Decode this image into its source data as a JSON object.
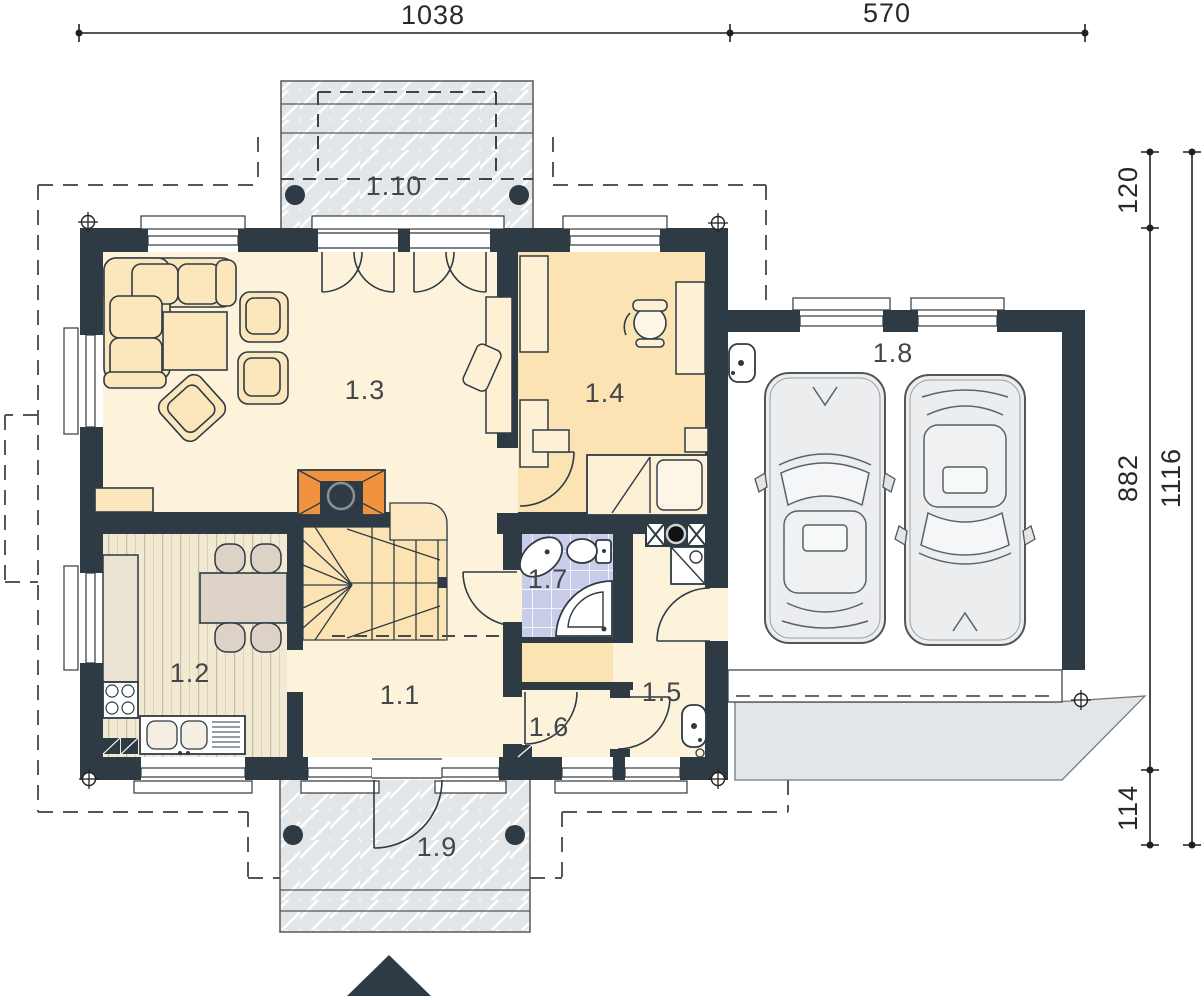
{
  "plan": {
    "type": "architectural-floor-plan",
    "rooms": [
      {
        "id": "hall",
        "label": "1.1"
      },
      {
        "id": "kitchen",
        "label": "1.2"
      },
      {
        "id": "living-room",
        "label": "1.3"
      },
      {
        "id": "bedroom",
        "label": "1.4"
      },
      {
        "id": "utility",
        "label": "1.5"
      },
      {
        "id": "vestibule",
        "label": "1.6"
      },
      {
        "id": "bathroom",
        "label": "1.7"
      },
      {
        "id": "garage",
        "label": "1.8"
      },
      {
        "id": "porch",
        "label": "1.9"
      },
      {
        "id": "terrace",
        "label": "1.10"
      }
    ],
    "dimensions": {
      "top": [
        {
          "label": "1038"
        },
        {
          "label": "570"
        }
      ],
      "right": [
        {
          "label": "120"
        },
        {
          "label": "882"
        },
        {
          "label": "1116"
        },
        {
          "label": "114"
        }
      ]
    },
    "colors": {
      "wall": "#2e3b44",
      "floor_cream": "#fdf3da",
      "floor_peach": "#fbe3b4",
      "kitchen_floor": "#f2e9d2",
      "bathroom_tile": "#c9cde9",
      "terrace": "#e3e6e8",
      "fireplace": "#f0923e",
      "furniture": "#fbe7bb"
    }
  }
}
